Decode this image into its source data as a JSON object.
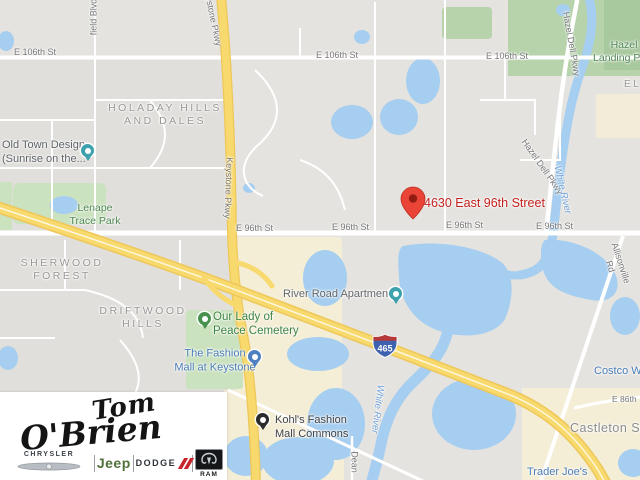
{
  "map": {
    "address_label": "4630 East 96th Street",
    "highway_shield": "465",
    "street_labels": [
      "E 106th St",
      "E 106th St",
      "E 106th St",
      "E 96th St",
      "E 96th St",
      "E 96th St",
      "E 96th St",
      "field Blvd",
      "Keystone Pkwy",
      "Keystone Pkwy",
      "Hazel Dell Pkwy",
      "Hazel Dell Pkwy",
      "Dean",
      "Allisonville Rd",
      "E 86th"
    ],
    "river_labels": [
      "White River",
      "White River"
    ],
    "neighborhoods": [
      "HOLADAY HILLS\nAND DALES",
      "SHERWOOD\nFOREST",
      "DRIFTWOOD\nHILLS",
      "EL",
      "Castleton Squar"
    ],
    "parks": [
      "Lenape\nTrace Park",
      "Hazel\nLanding Park",
      "Our Lady of\nPeace Cemetery"
    ],
    "pois": [
      "Old Town Design\n(Sunrise on the...",
      "The Fashion\nMall at Keystone",
      "River Road Apartments",
      "Kohl's Fashion\nMall Commons",
      "Costco Wh",
      "Trader Joe's"
    ]
  },
  "logo": {
    "dealership_line1": "Tom",
    "dealership_line2": "O'Brien",
    "brands": [
      "CHRYSLER",
      "Jeep",
      "DODGE",
      "RAM"
    ]
  },
  "colors": {
    "map_base": "#e5e3df",
    "highway_yellow": "#f8d96d",
    "water_blue": "#a6cef0",
    "park_green": "#cbe2bf",
    "commercial_beige": "#f5eed6",
    "marker_red": "#e94436",
    "address_red": "#c5221f",
    "poi_blue": "#4a7db6",
    "park_label_green": "#4e8652",
    "jeep_green": "#51713b",
    "dodge_red": "#c9252c"
  }
}
